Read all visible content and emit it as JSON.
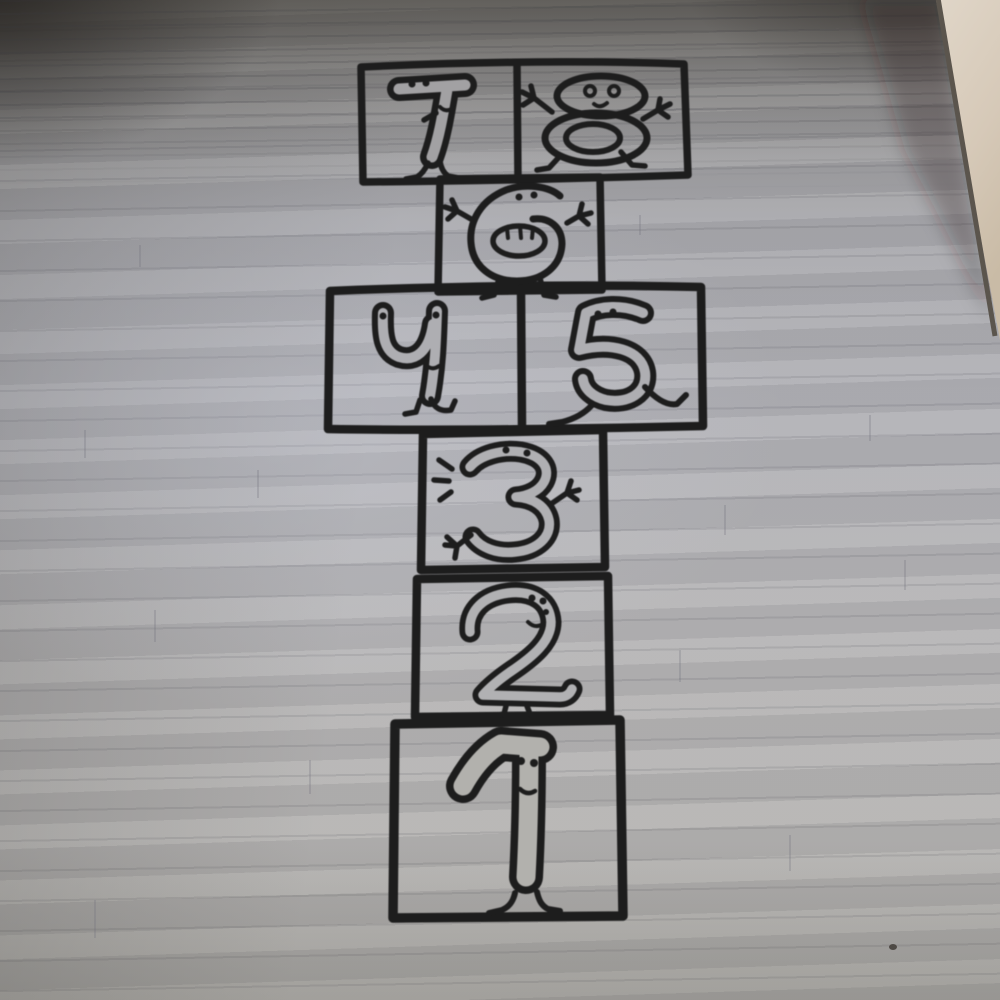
{
  "scene": {
    "description": "Photograph of a hand-drawn style hopscotch court decal applied to a grey wood-plank laminate floor, viewed at a slight angle; a beige wall corner is visible at the top right",
    "subject": "Hopscotch floor sticker with cartoon numeral characters 1 to 8",
    "floor_material": "grey laminate wood planks",
    "wall": "beige wall corner, top right",
    "camera_view": "standing view looking along the court from square 1 toward squares 7 and 8"
  },
  "colors": {
    "decal_ink": "#1d1d1d",
    "floor_light_grey": "#b1b0b1",
    "floor_mid_grey": "#a3a3a7",
    "floor_dark_top": "#6e6c68",
    "wall_beige": "#d6c9b8"
  },
  "hopscotch": {
    "squares_total": 8,
    "rows_top_to_bottom": [
      {
        "cells": "7 | 8"
      },
      {
        "cells": "6"
      },
      {
        "cells": "4 | 5"
      },
      {
        "cells": "3"
      },
      {
        "cells": "2"
      },
      {
        "cells": "1"
      }
    ],
    "squares": {
      "s1": {
        "number": "1",
        "label": "Hopscotch square 1: tall numeral one character with two dot eyes, a smile and two walking feet"
      },
      "s2": {
        "number": "2",
        "label": "Hopscotch square 2: numeral two character with dot eyes, a smile and two small legs"
      },
      "s3": {
        "number": "3",
        "label": "Hopscotch square 3: numeral three character with dot eyes, two three-fingered hands and motion dashes on the left"
      },
      "s4": {
        "number": "4",
        "label": "Hopscotch square 4: rounded numeral four character with an eye in each prong, a smile and walking legs"
      },
      "s5": {
        "number": "5",
        "label": "Hopscotch square 5: numeral five character with dot eyes on its top bar and running legs"
      },
      "s6": {
        "number": "6",
        "label": "Hopscotch square 6: numeral six character with dot eyes, a wide open mouth with teeth, raised arms and two legs"
      },
      "s7": {
        "number": "7",
        "label": "Hopscotch square 7: numeral seven character with dot eyes on its top bar, a smile, a small arm and two feet"
      },
      "s8": {
        "number": "8",
        "label": "Hopscotch square 8: snowman-like numeral eight character with round eyes, a smile, raised arms and two feet"
      }
    }
  }
}
